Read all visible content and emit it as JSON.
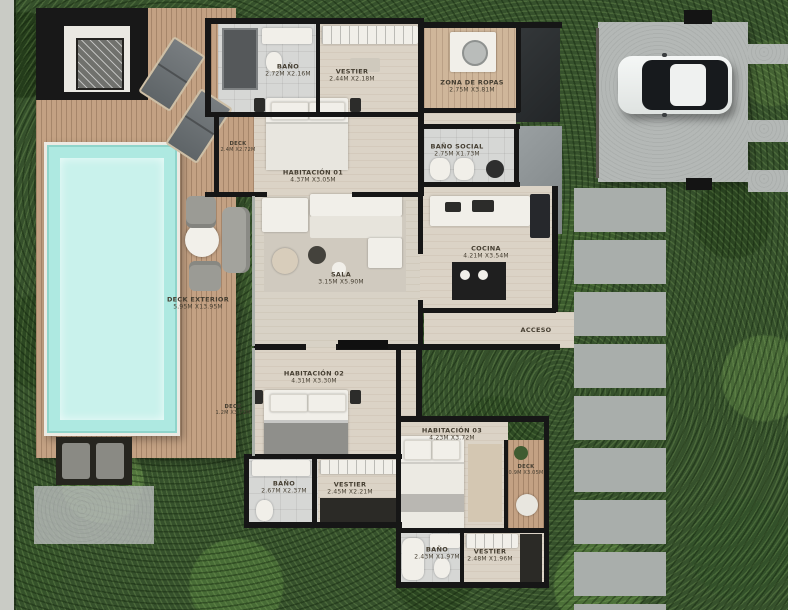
{
  "palette": {
    "foliage_green": "#36512c",
    "deck_wood": "#c3a183",
    "pool_water": "#aee9e1",
    "wall_black": "#161616",
    "floor_beige": "#dbd3c6",
    "bath_tile_gray": "#d6d7d5",
    "concrete_gray": "#b4b8b6",
    "car_body_white": "#eef0ef"
  },
  "labels": [
    {
      "id": "bano-principal",
      "name": "BAÑO",
      "dims": "2.72M X2.16M"
    },
    {
      "id": "vestier-principal",
      "name": "VESTIER",
      "dims": "2.44M X2.18M"
    },
    {
      "id": "habitacion-01",
      "name": "HABITACIÓN 01",
      "dims": "4.37M X3.05M"
    },
    {
      "id": "zona-de-ropas",
      "name": "ZONA DE ROPAS",
      "dims": "2.75M X3.81M"
    },
    {
      "id": "bano-social",
      "name": "BAÑO SOCIAL",
      "dims": "2.75M X1.73M"
    },
    {
      "id": "cocina",
      "name": "COCINA",
      "dims": "4.21M X3.54M"
    },
    {
      "id": "sala",
      "name": "SALA",
      "dims": "3.15M X5.90M"
    },
    {
      "id": "deck-exterior",
      "name": "DECK EXTERIOR",
      "dims": "5.95M X13.95M"
    },
    {
      "id": "acceso",
      "name": "ACCESO",
      "dims": ""
    },
    {
      "id": "habitacion-02",
      "name": "HABITACIÓN 02",
      "dims": "4.31M X3.30M"
    },
    {
      "id": "bano-hab02",
      "name": "BAÑO",
      "dims": "2.67M X2.37M"
    },
    {
      "id": "vestier-hab02",
      "name": "VESTIER",
      "dims": "2.45M X2.21M"
    },
    {
      "id": "habitacion-03",
      "name": "HABITACIÓN 03",
      "dims": "4.23M X3.72M"
    },
    {
      "id": "bano-hab03",
      "name": "BAÑO",
      "dims": "2.43M X1.97M"
    },
    {
      "id": "vestier-hab03",
      "name": "VESTIER",
      "dims": "2.48M X1.96M"
    },
    {
      "id": "deck-lateral-01",
      "name": "DECK",
      "dims": "2.4M X2.72M"
    },
    {
      "id": "deck-lateral-02",
      "name": "DECK",
      "dims": "1.2M X3.72M"
    },
    {
      "id": "deck-lateral-03",
      "name": "DECK",
      "dims": "0.9M X3.05M"
    }
  ]
}
